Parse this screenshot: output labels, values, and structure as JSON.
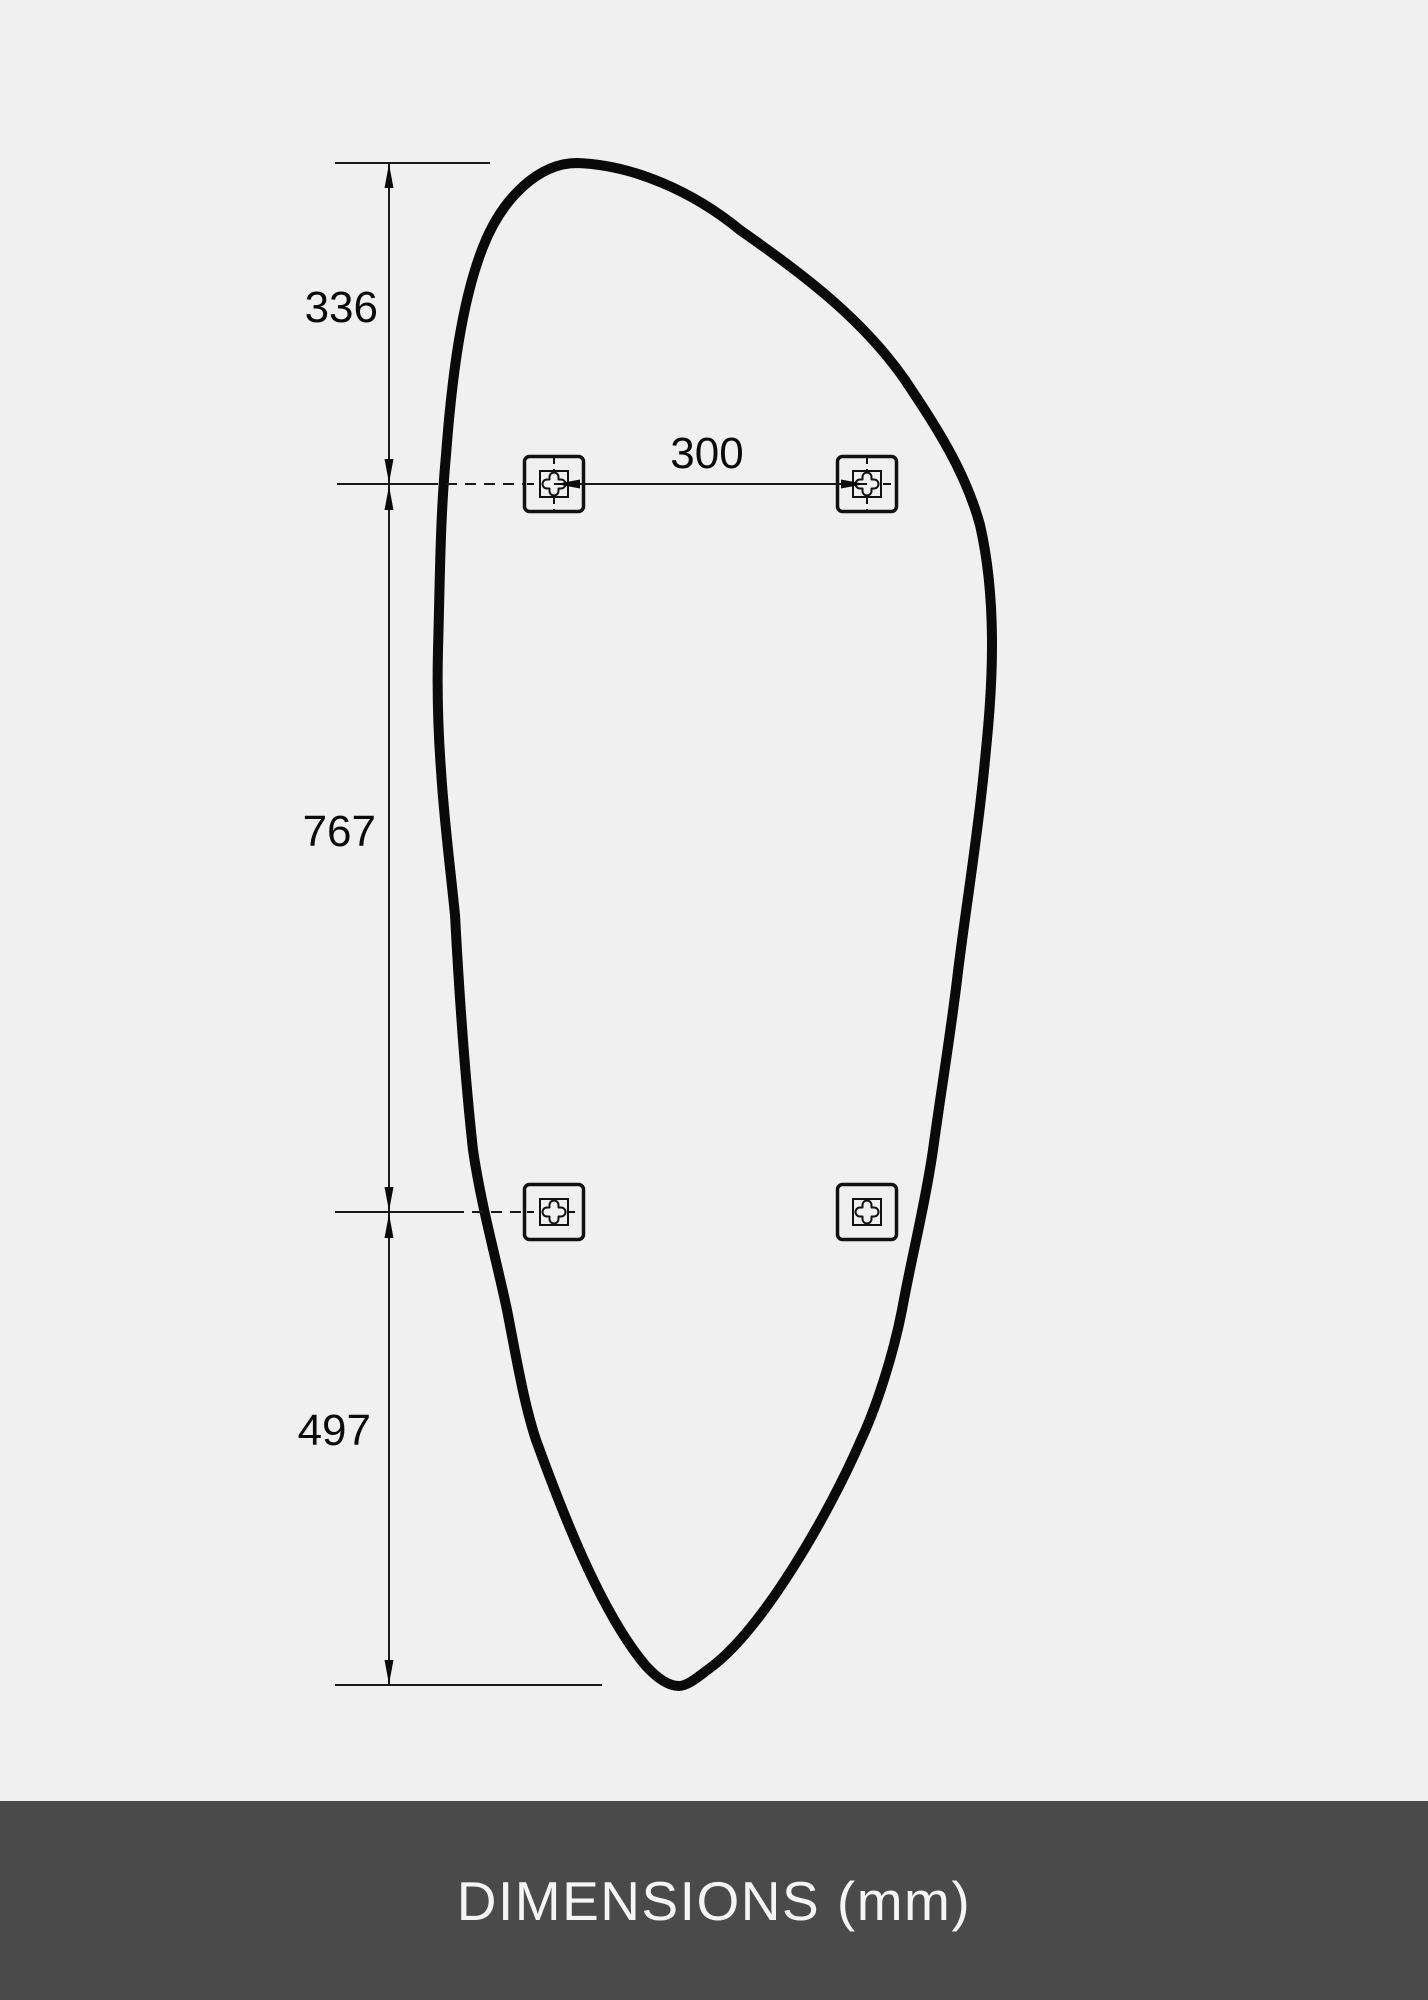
{
  "diagram": {
    "type": "technical-dimension-drawing",
    "subject": "organic-shaped mirror with four mounting brackets",
    "unit": "mm",
    "dimensions": {
      "top_edge_to_upper_brackets": "336",
      "upper_brackets_to_lower_brackets": "767",
      "lower_brackets_to_bottom_edge": "497",
      "upper_bracket_spacing": "300"
    },
    "mounting_brackets": {
      "count": 4,
      "positions": [
        "top-left",
        "top-right",
        "bottom-left",
        "bottom-right"
      ]
    },
    "colors": {
      "background": "#f0f0f0",
      "outline": "#0a0a0a",
      "dimension_line": "#1a1a1a",
      "footer_bar": "#4a4a4a",
      "footer_text": "#f5f5f5"
    }
  },
  "footer": {
    "caption": "DIMENSIONS (mm)"
  }
}
